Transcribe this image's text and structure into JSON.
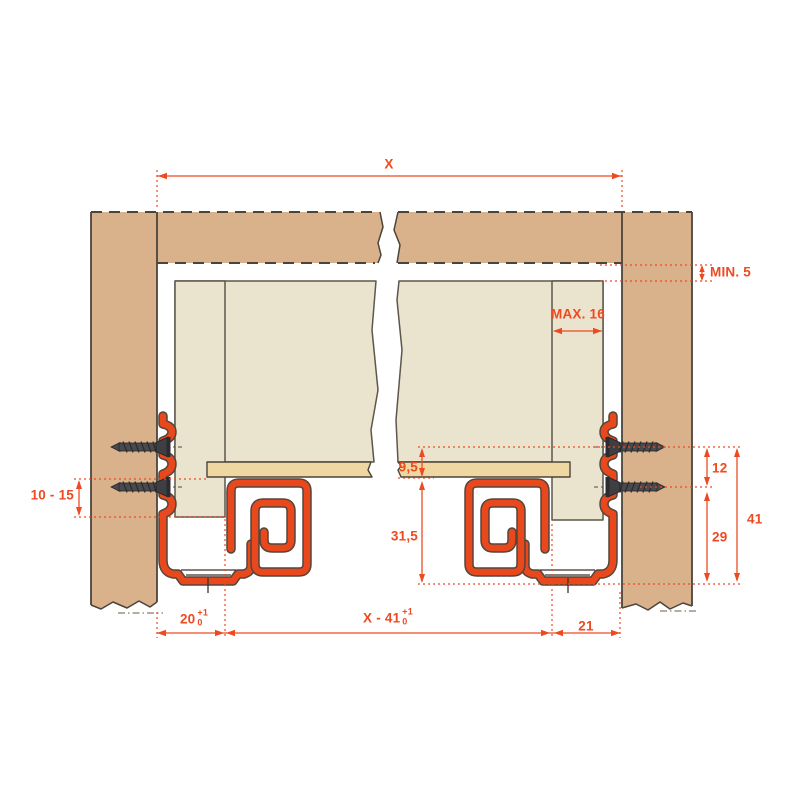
{
  "dimensions": {
    "cabinet_inner_width": "X",
    "min_top_clearance": "MIN. 5",
    "max_side_thickness": "MAX. 16",
    "bottom_panel_thickness": "9,5",
    "below_bottom_height": "31,5",
    "screw_rows_gap": "12",
    "lower_screw_row_height": "29",
    "upper_screw_row_height": "41",
    "screw_edge_range": "10 - 15",
    "front_offset": "20",
    "center_span": "X - 41",
    "back_offset": "21",
    "tolerance_plus": "+1",
    "tolerance_minus": "0"
  },
  "colors": {
    "dimension_red": "#ee4a21",
    "hardware_red": "#e8481c",
    "cabinet_panel_tan": "#d9b28c",
    "drawer_cream": "#eae4ce",
    "drawer_bottom_wheat": "#eed7a0",
    "outline_dark": "#4b443b",
    "screw_gray": "#4a4a4e",
    "background": "#ffffff"
  }
}
